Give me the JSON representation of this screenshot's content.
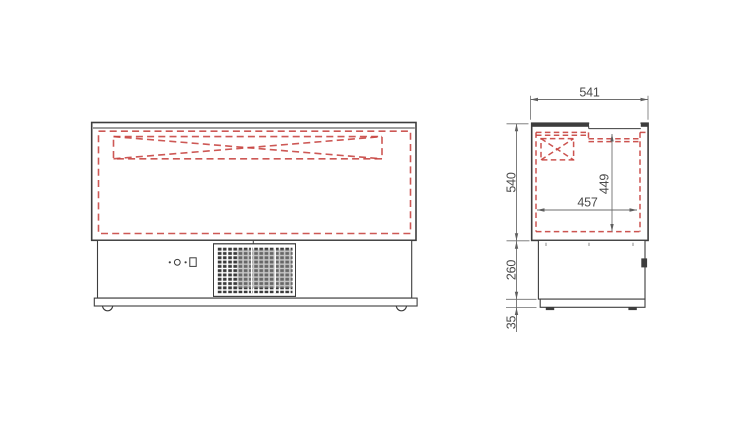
{
  "drawing": {
    "type": "technical-drawing-two-views",
    "dimensions": {
      "top_width": "541",
      "body_height": "540",
      "interior_height": "449",
      "interior_width": "457",
      "base_height": "260",
      "plinth_height": "35"
    },
    "colors": {
      "outline": "#3d3d3d",
      "hidden_line": "#c6413d",
      "dimension_line": "#6e6e6e",
      "dimension_text": "#4a4a4a",
      "grille_dark": "#3a3a3a",
      "grille_overlay": "#949494"
    }
  }
}
